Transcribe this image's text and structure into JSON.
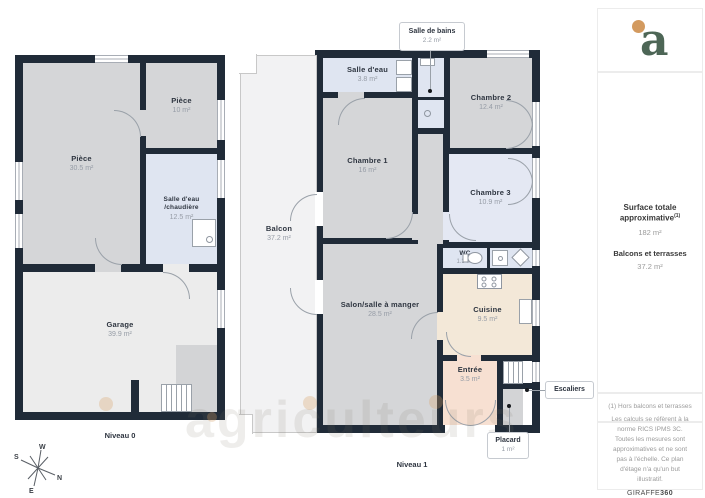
{
  "meta": {
    "watermark": "agriculteurs"
  },
  "colors": {
    "wall": "#202b38",
    "room_gray": "#d5d6d8",
    "room_blue": "#dfe5f1",
    "garage": "#ececec",
    "balcony": "#f2f2f3",
    "kitchen": "#f3e8d8",
    "entry": "#f7e0d2",
    "logo_green": "#4d6656",
    "logo_dot": "#d39a5f"
  },
  "niveau0": {
    "label": "Niveau 0",
    "rooms": [
      {
        "name": "Pièce",
        "area": "30.5 m²"
      },
      {
        "name": "Pièce",
        "area": "10 m²"
      },
      {
        "name": "Salle d'eau /chaudière",
        "area": "12.5 m²"
      },
      {
        "name": "Garage",
        "area": "39.9 m²"
      }
    ]
  },
  "niveau1": {
    "label": "Niveau 1",
    "rooms": [
      {
        "name": "Balcon",
        "area": "37.2 m²"
      },
      {
        "name": "Salle d'eau",
        "area": "3.8 m²"
      },
      {
        "name": "Chambre 2",
        "area": "12.4 m²"
      },
      {
        "name": "Chambre 1",
        "area": "16 m²"
      },
      {
        "name": "Chambre 3",
        "area": "10.9 m²"
      },
      {
        "name": "WC",
        "area": "1.3 m²"
      },
      {
        "name": "Salon/salle à manger",
        "area": "28.5 m²"
      },
      {
        "name": "Cuisine",
        "area": "9.5 m²"
      },
      {
        "name": "Entrée",
        "area": "3.5 m²"
      }
    ],
    "callouts": [
      {
        "name": "Salle de bains",
        "area": "2.2 m²"
      },
      {
        "name": "Escaliers",
        "area": ""
      },
      {
        "name": "Placard",
        "area": "1 m²"
      }
    ]
  },
  "compass": {
    "n": "N",
    "s": "S",
    "e": "E",
    "w": "W"
  },
  "sidebar": {
    "logo": "a",
    "surface_title": "Surface totale approximative",
    "surface_sup": "(1)",
    "surface_value": "182 m²",
    "balcony_title": "Balcons et terrasses",
    "balcony_value": "37.2 m²",
    "footnote": "(1) Hors balcons et terrasses",
    "disclaimer": "Les calculs se réfèrent à la norme RICS IPMS 3C. Toutes les mesures sont approximatives et ne sont pas à l'échelle. Ce plan d'étage n'a qu'un but illustratif.",
    "brand": "GIRAFFE",
    "brand_suffix": "360"
  }
}
